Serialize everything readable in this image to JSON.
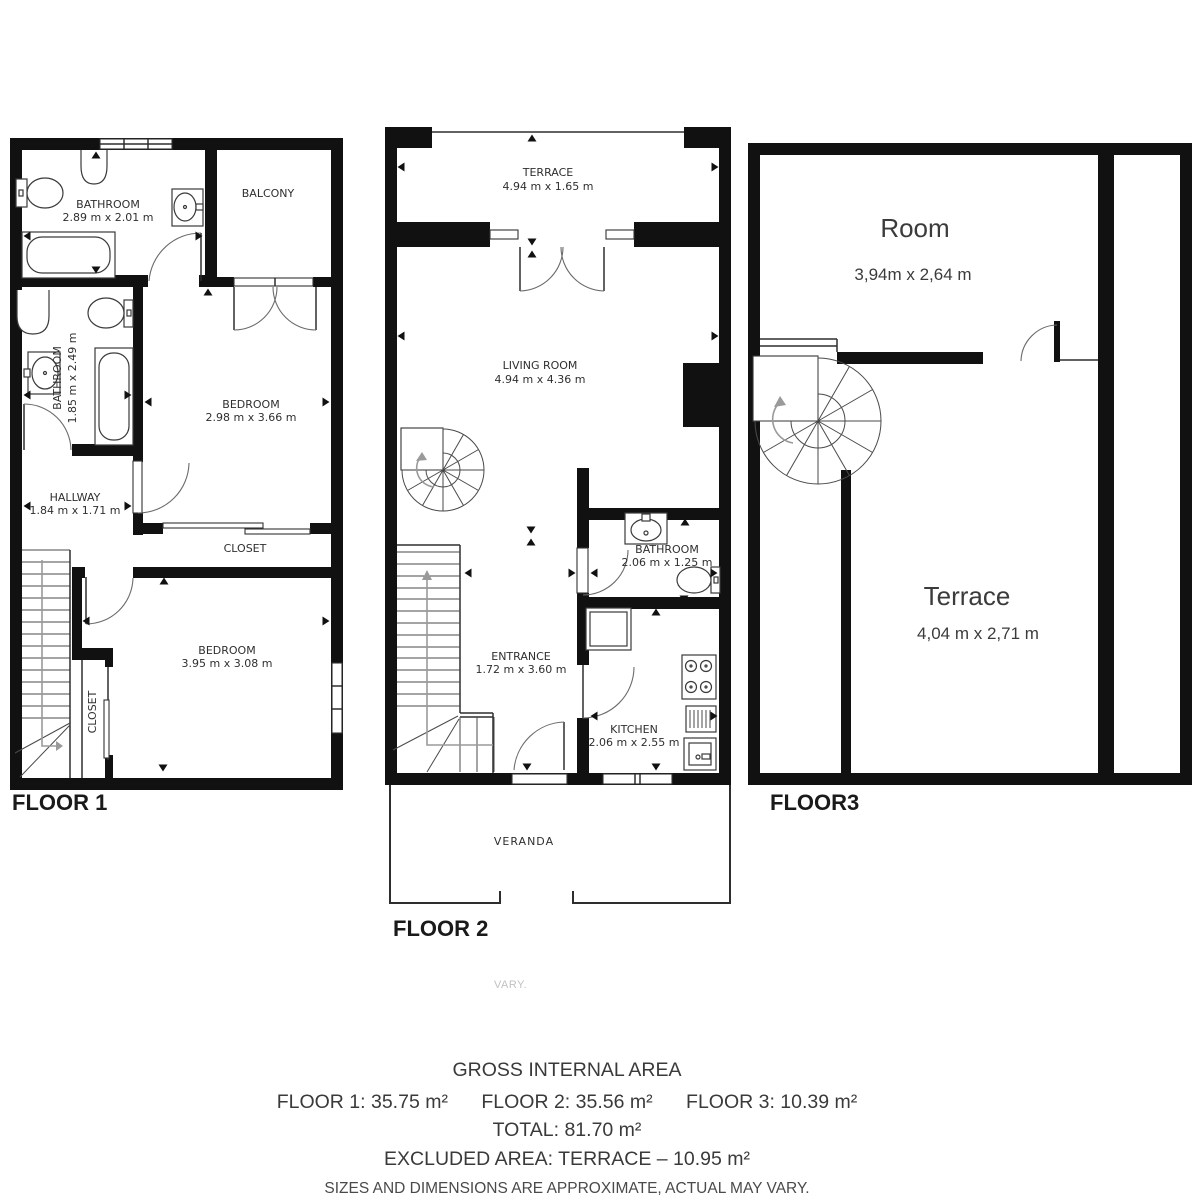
{
  "colors": {
    "wall": "#111111",
    "plan_line": "#333333",
    "plan_text": "#2f2f2f",
    "footer_text": "#3a3a3a",
    "faint_text": "#c2c2c2"
  },
  "floor1": {
    "label": "FLOOR 1",
    "rooms": {
      "bathroom_top": {
        "name": "BATHROOM",
        "dims": "2.89 m x 2.01 m"
      },
      "balcony": {
        "name": "BALCONY"
      },
      "bathroom_side": {
        "name": "BATHROOM",
        "dims": "1.85 m x 2.49 m"
      },
      "bedroom_top": {
        "name": "BEDROOM",
        "dims": "2.98 m x 3.66 m"
      },
      "hallway": {
        "name": "HALLWAY",
        "dims": "1.84 m x 1.71 m"
      },
      "closet_strip": {
        "name": "CLOSET"
      },
      "bedroom_bottom": {
        "name": "BEDROOM",
        "dims": "3.95 m x 3.08 m"
      },
      "closet_small": {
        "name": "CLOSET"
      }
    }
  },
  "floor2": {
    "label": "FLOOR 2",
    "rooms": {
      "terrace": {
        "name": "TERRACE",
        "dims": "4.94 m x 1.65 m"
      },
      "living_room": {
        "name": "LIVING ROOM",
        "dims": "4.94 m x 4.36 m"
      },
      "bathroom": {
        "name": "BATHROOM",
        "dims": "2.06 m x 1.25 m"
      },
      "entrance": {
        "name": "ENTRANCE",
        "dims": "1.72 m x 3.60 m"
      },
      "kitchen": {
        "name": "KITCHEN",
        "dims": "2.06 m x 2.55 m"
      },
      "veranda": {
        "name": "VERANDA"
      }
    }
  },
  "floor3": {
    "label": "FLOOR3",
    "rooms": {
      "room": {
        "name": "Room",
        "dims": "3,94m x 2,64 m"
      },
      "terrace": {
        "name": "Terrace",
        "dims": "4,04 m x 2,71 m"
      }
    }
  },
  "footer": {
    "stray": "VARY.",
    "title": "GROSS INTERNAL AREA",
    "floor1_area": "FLOOR 1: 35.75 m²",
    "floor2_area": "FLOOR 2: 35.56 m²",
    "floor3_area": "FLOOR 3: 10.39 m²",
    "total_line": "TOTAL: 81.70 m²",
    "excluded_line": "EXCLUDED AREA: TERRACE – 10.95 m²",
    "disclaimer": "SIZES AND DIMENSIONS ARE APPROXIMATE, ACTUAL MAY VARY."
  }
}
